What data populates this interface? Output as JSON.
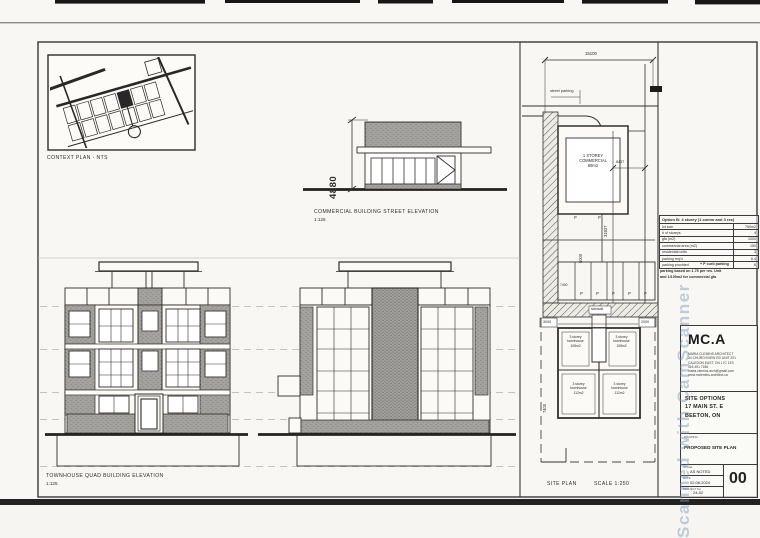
{
  "colors": {
    "paper": "#f8f7f3",
    "ink": "#2f2d2a",
    "hatch_gray": "#8f8f8f",
    "watermark_blue": "#7a94b8"
  },
  "context_plan": {
    "caption": "CONTEXT PLAN - NTS"
  },
  "commercial_elevation": {
    "caption": "COMMERCIAL BUILDING STREET ELEVATION",
    "scale": "1:125",
    "height_dim": "4880"
  },
  "townhouse_elevation": {
    "caption": "TOWNHOUSE QUAD BUILDING ELEVATION",
    "scale": "1:125"
  },
  "site_plan": {
    "caption": "SITE PLAN",
    "scale": "SCALE 1:250",
    "street_parking": "street parking",
    "sidewalk": "sidewalk",
    "parking_mark": "P",
    "commercial": {
      "l1": "1 STOREY",
      "l2": "COMMERCIAL",
      "l3": "89m2"
    },
    "dims": {
      "frontage": "15100",
      "depth": "31937",
      "commercial_depth": "8437",
      "courtyard": "6000",
      "aisle": "7400",
      "side_left": "3000",
      "side_right": "2000",
      "rear_yard": "7400"
    },
    "units": [
      {
        "l1": "3 storey",
        "l2": "townhouse",
        "l3": "108m2"
      },
      {
        "l1": "3 storey",
        "l2": "townhouse",
        "l3": "108m2"
      },
      {
        "l1": "3 storey",
        "l2": "townhouse",
        "l3": "112m2"
      },
      {
        "l1": "3 storey",
        "l2": "townhouse",
        "l3": "112m2"
      }
    ]
  },
  "option_table": {
    "title": "Option B: 4 storey (1 comm and 3 res)",
    "rows": [
      {
        "label": "lot size",
        "value": "750m2"
      },
      {
        "label": "# of storeys",
        "value": "4"
      },
      {
        "label": "gfa (m2)",
        "value": "1000"
      },
      {
        "label": "commercial area (m2)",
        "value": "150"
      },
      {
        "label": "residential units",
        "value": "3"
      },
      {
        "label": "parking req'd",
        "value": "6.4"
      },
      {
        "label": "parking provided",
        "value": "6"
      }
    ],
    "note_curb": "+ P curb parking",
    "note_basis_1": "parking based on 1.75 per res. Unit",
    "note_basis_2": "and 1/100m2 for commercial gfa"
  },
  "title_block": {
    "logo": "MC.A",
    "firm_lines": [
      "MARIA CLEMINS ARCHITECT",
      "34 CHURCHVIEW RD UNIT 201",
      "CALEDON EAST, ON L7C 1E3",
      "416 451 7186",
      "maria.clemins.arch@gmail.com",
      "www.mclemins-architect.ca"
    ],
    "project_lines": [
      "SITE OPTIONS",
      "17 MAIN ST. E",
      "BEETON, ON"
    ],
    "drawing_title": "PROPOSED SITE PLAN",
    "fields": [
      {
        "label": "SCALE",
        "value": "AS NOTED"
      },
      {
        "label": "DATE",
        "value": "02.08.2024"
      },
      {
        "label": "PROJECT No",
        "value": "24-02"
      }
    ],
    "sheet_number": "00"
  },
  "watermark": "Scanned with CamScanner"
}
